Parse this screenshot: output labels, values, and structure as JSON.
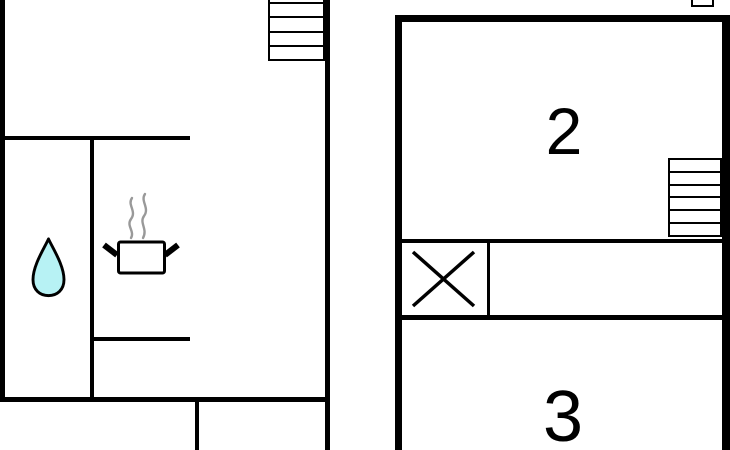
{
  "colors": {
    "wall": "#000000",
    "background": "#ffffff",
    "water_drop_fill": "#b7f2f4",
    "water_drop_outline": "#000000",
    "steam": "#999999"
  },
  "left_plan": {
    "icons": [
      {
        "name": "stairs-icon"
      },
      {
        "name": "water-drop-icon"
      },
      {
        "name": "cooking-pot-icon"
      }
    ]
  },
  "right_plan": {
    "rooms": [
      {
        "label": "2"
      },
      {
        "label": "3"
      }
    ],
    "icons": [
      {
        "name": "stairs-icon"
      },
      {
        "name": "crossed-box-icon"
      },
      {
        "name": "window-icon"
      }
    ]
  }
}
